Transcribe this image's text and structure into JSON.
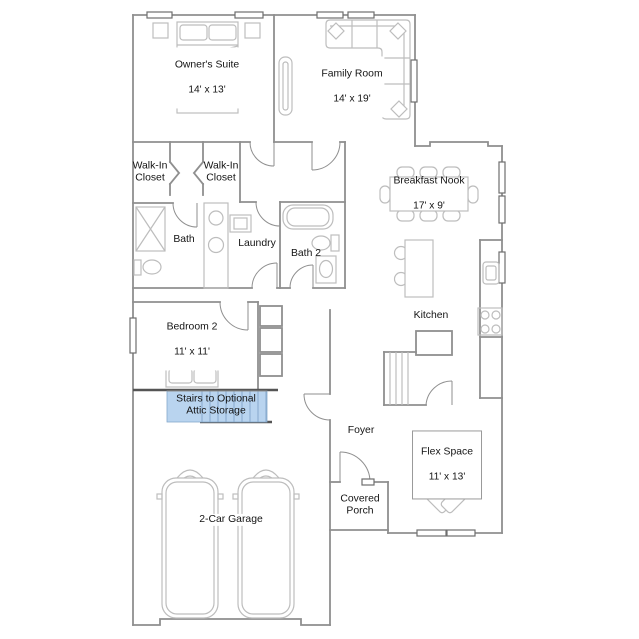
{
  "plan": {
    "title": "Single-story floor plan",
    "rooms": {
      "owners_suite": {
        "name": "Owner's Suite",
        "dims": "14' x 13'"
      },
      "family_room": {
        "name": "Family Room",
        "dims": "14' x 19'"
      },
      "walk_in_closet_left": {
        "name": "Walk-In\nCloset"
      },
      "walk_in_closet_right": {
        "name": "Walk-In\nCloset"
      },
      "bath": {
        "name": "Bath"
      },
      "laundry": {
        "name": "Laundry"
      },
      "bath_2": {
        "name": "Bath 2"
      },
      "breakfast_nook": {
        "name": "Breakfast Nook",
        "dims": "17' x 9'"
      },
      "kitchen": {
        "name": "Kitchen"
      },
      "bedroom_2": {
        "name": "Bedroom 2",
        "dims": "11' x 11'"
      },
      "stairs": {
        "name": "Stairs to Optional\nAttic Storage"
      },
      "foyer": {
        "name": "Foyer"
      },
      "flex_space": {
        "name": "Flex Space",
        "dims": "11' x 13'"
      },
      "covered_porch": {
        "name": "Covered\nPorch"
      },
      "garage": {
        "name": "2-Car Garage"
      }
    },
    "colors": {
      "wall": "#8f8f8f",
      "walldark": "#555555",
      "furn": "#bdbdbd",
      "text": "#141414",
      "highlight": "#b9d4ef",
      "highlightline": "#86a9cc",
      "windowframe": "#6f6f6f",
      "bg": "#ffffff"
    }
  }
}
